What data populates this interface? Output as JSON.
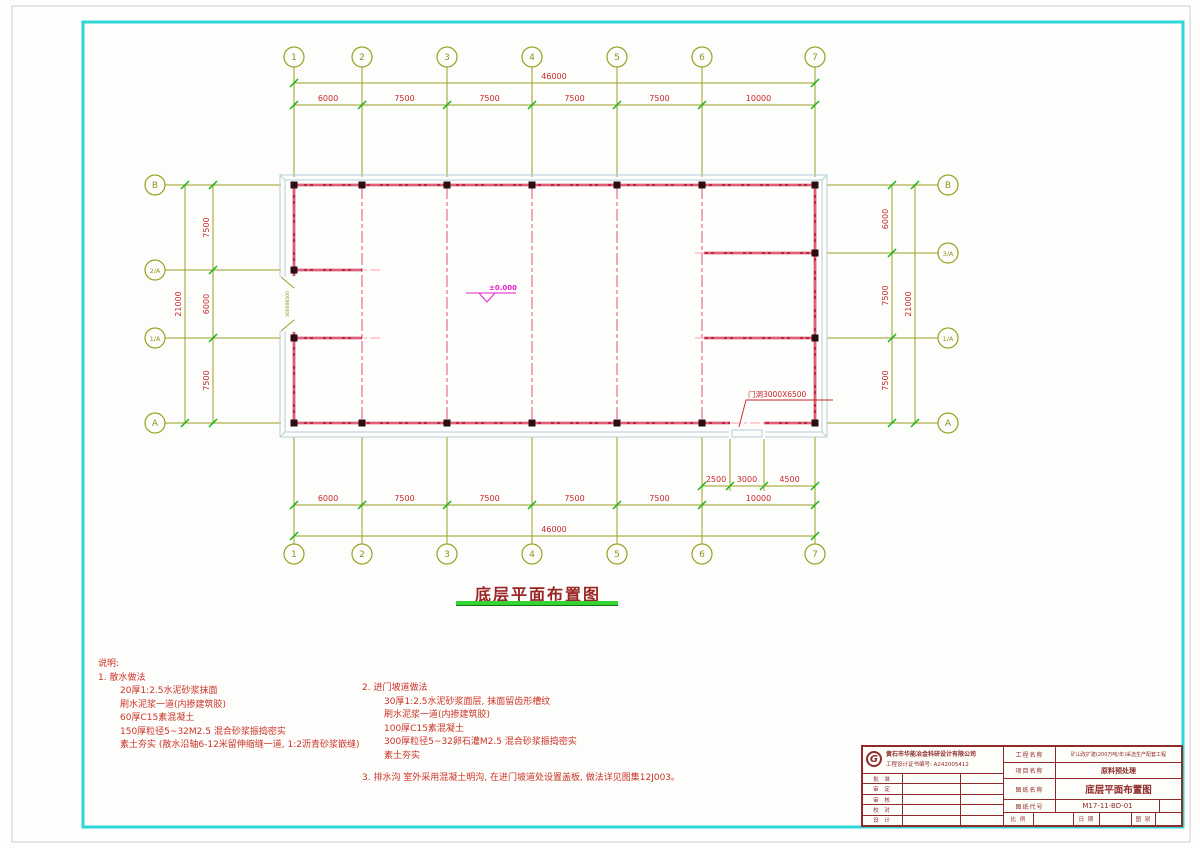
{
  "axes": {
    "cols": [
      "1",
      "2",
      "3",
      "4",
      "5",
      "6",
      "7"
    ],
    "left_rows": [
      "B",
      "2/A",
      "1/A",
      "A"
    ],
    "right_rows": [
      "B",
      "3/A",
      "1/A",
      "A"
    ]
  },
  "dimensions": {
    "top_total": "46000",
    "top_segments": [
      "6000",
      "7500",
      "7500",
      "7500",
      "7500",
      "10000"
    ],
    "bottom_total": "46000",
    "bottom_segments": [
      "6000",
      "7500",
      "7500",
      "7500",
      "7500",
      "10000"
    ],
    "bottom_detail": [
      "2500",
      "3000",
      "4500"
    ],
    "left_total": "21000",
    "left_segments": [
      "7500",
      "6000",
      "7500"
    ],
    "right_total": "21000",
    "right_segments": [
      "6000",
      "7500",
      "7500"
    ]
  },
  "plan": {
    "elevation": "±0.000",
    "door_label": "门洞3000X6500",
    "left_door_label": "3000X6500"
  },
  "drawing_title": "底层平面布置图",
  "notes": {
    "heading": "说明:",
    "item1_title": "1. 散水做法",
    "item1_lines": [
      "20厚1:2.5水泥砂浆抹面",
      "刷水泥浆一道(内掺建筑胶)",
      "60厚C15素混凝土",
      "150厚粒径5~32M2.5 混合砂浆振捣密实",
      "素土夯实 (散水沿轴6-12米留伸缩缝一道, 1:2沥青砂浆嵌缝)"
    ],
    "item2_title": "2. 进门坡道做法",
    "item2_lines": [
      "30厚1:2.5水泥砂浆面层, 抹面留齿形槽纹",
      "刷水泥浆一道(内掺建筑胶)",
      "100厚C15素混凝土",
      "300厚粒径5~32卵石灌M2.5 混合砂浆振捣密实",
      "素土夯实"
    ],
    "item3": "3. 排水沟 室外采用混凝土明沟, 在进门坡道处设置盖板, 做法详见图集12J003。"
  },
  "title_block": {
    "logo": "G",
    "company": "黄石市华能冶金科研设计有限公司",
    "cert": "工程设计证书编号: A242005412",
    "sign_rows": [
      "批 准",
      "审 定",
      "审 核",
      "校 对",
      "设 计"
    ],
    "project_label": "工程名称",
    "project_value": "矿山改扩建(200万吨/年)采选生产配套工程",
    "item_label": "项目名称",
    "item_value": "原料预处理",
    "sheet_label": "图纸名称",
    "sheet_value": "底层平面布置图",
    "code_label": "图纸代号",
    "code_value": "M17-11-BD-01",
    "scale_label": "比 例",
    "date_label": "日 期",
    "type_label": "图 别"
  }
}
